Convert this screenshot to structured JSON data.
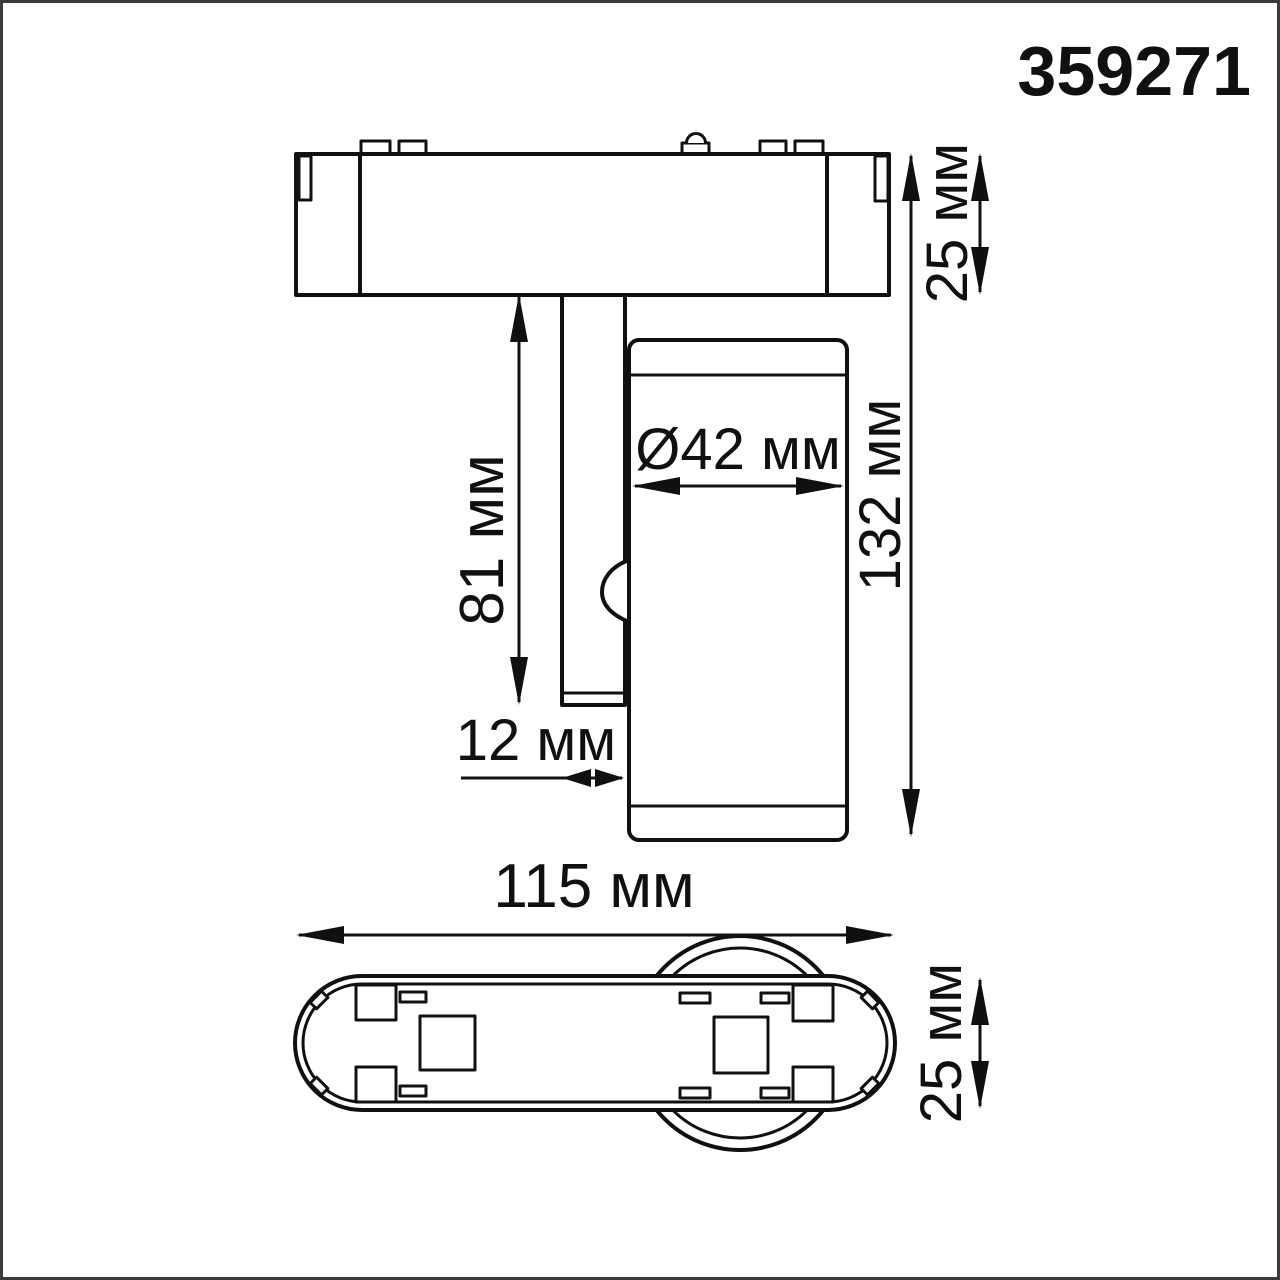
{
  "product_code": "359271",
  "views": {
    "side": {
      "dimensions": {
        "adapter_height": "25 мм",
        "stem_length": "81 мм",
        "head_diameter": "Ø42 мм",
        "total_height": "132 мм",
        "stem_width": "12 мм"
      }
    },
    "bottom": {
      "dimensions": {
        "length": "115 мм",
        "width": "25 мм"
      }
    }
  },
  "colors": {
    "line": "#101010",
    "frame": "#3b3b3b",
    "background": "#ffffff"
  }
}
